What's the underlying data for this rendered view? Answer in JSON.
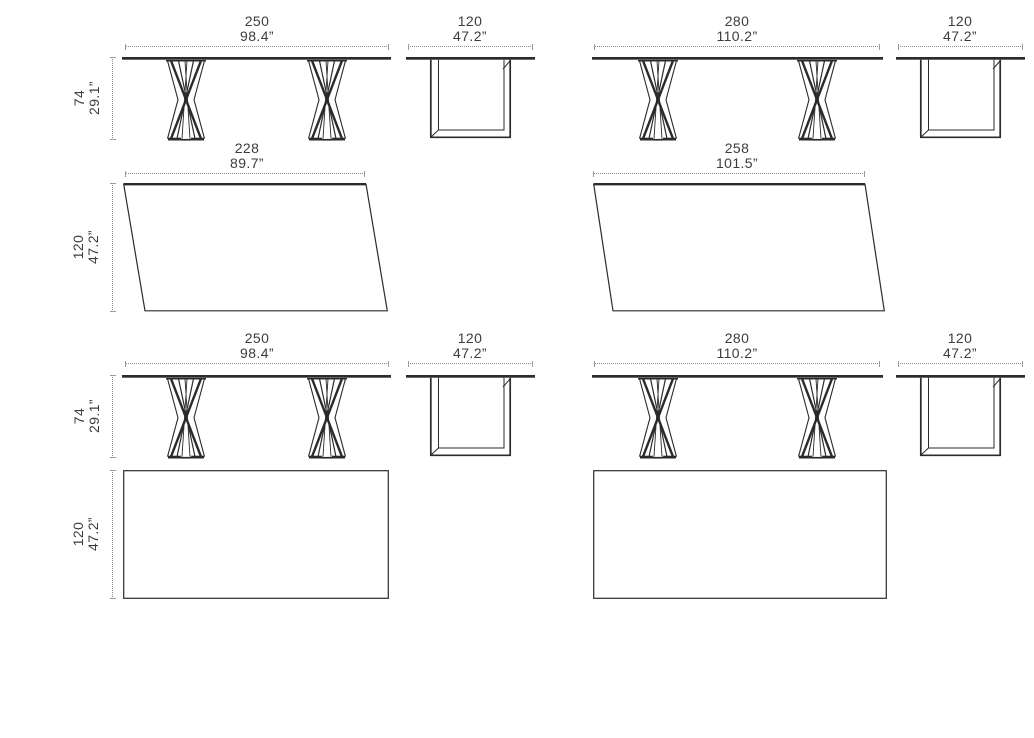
{
  "colors": {
    "line": "#2b2b2b",
    "dim_line": "#8a8a8a",
    "text": "#3c3c3c",
    "background": "#ffffff"
  },
  "diagram": {
    "subject": "table-dimension-drawings"
  },
  "dims": {
    "row1": {
      "front_left": {
        "cm": "250",
        "inches": "98.4”"
      },
      "side_left": {
        "cm": "120",
        "inches": "47.2”"
      },
      "front_right": {
        "cm": "280",
        "inches": "110.2”"
      },
      "side_right": {
        "cm": "120",
        "inches": "47.2”"
      },
      "height_left": {
        "cm": "74",
        "inches": "29.1”"
      }
    },
    "row2": {
      "top_left": {
        "cm": "228",
        "inches": "89.7”"
      },
      "top_right": {
        "cm": "258",
        "inches": "101.5”"
      },
      "depth_left": {
        "cm": "120",
        "inches": "47.2”"
      }
    },
    "row3": {
      "front_left": {
        "cm": "250",
        "inches": "98.4”"
      },
      "side_left": {
        "cm": "120",
        "inches": "47.2”"
      },
      "front_right": {
        "cm": "280",
        "inches": "110.2”"
      },
      "side_right": {
        "cm": "120",
        "inches": "47.2”"
      },
      "height_left": {
        "cm": "74",
        "inches": "29.1”"
      }
    },
    "row4": {
      "depth_left": {
        "cm": "120",
        "inches": "47.2”"
      }
    }
  }
}
